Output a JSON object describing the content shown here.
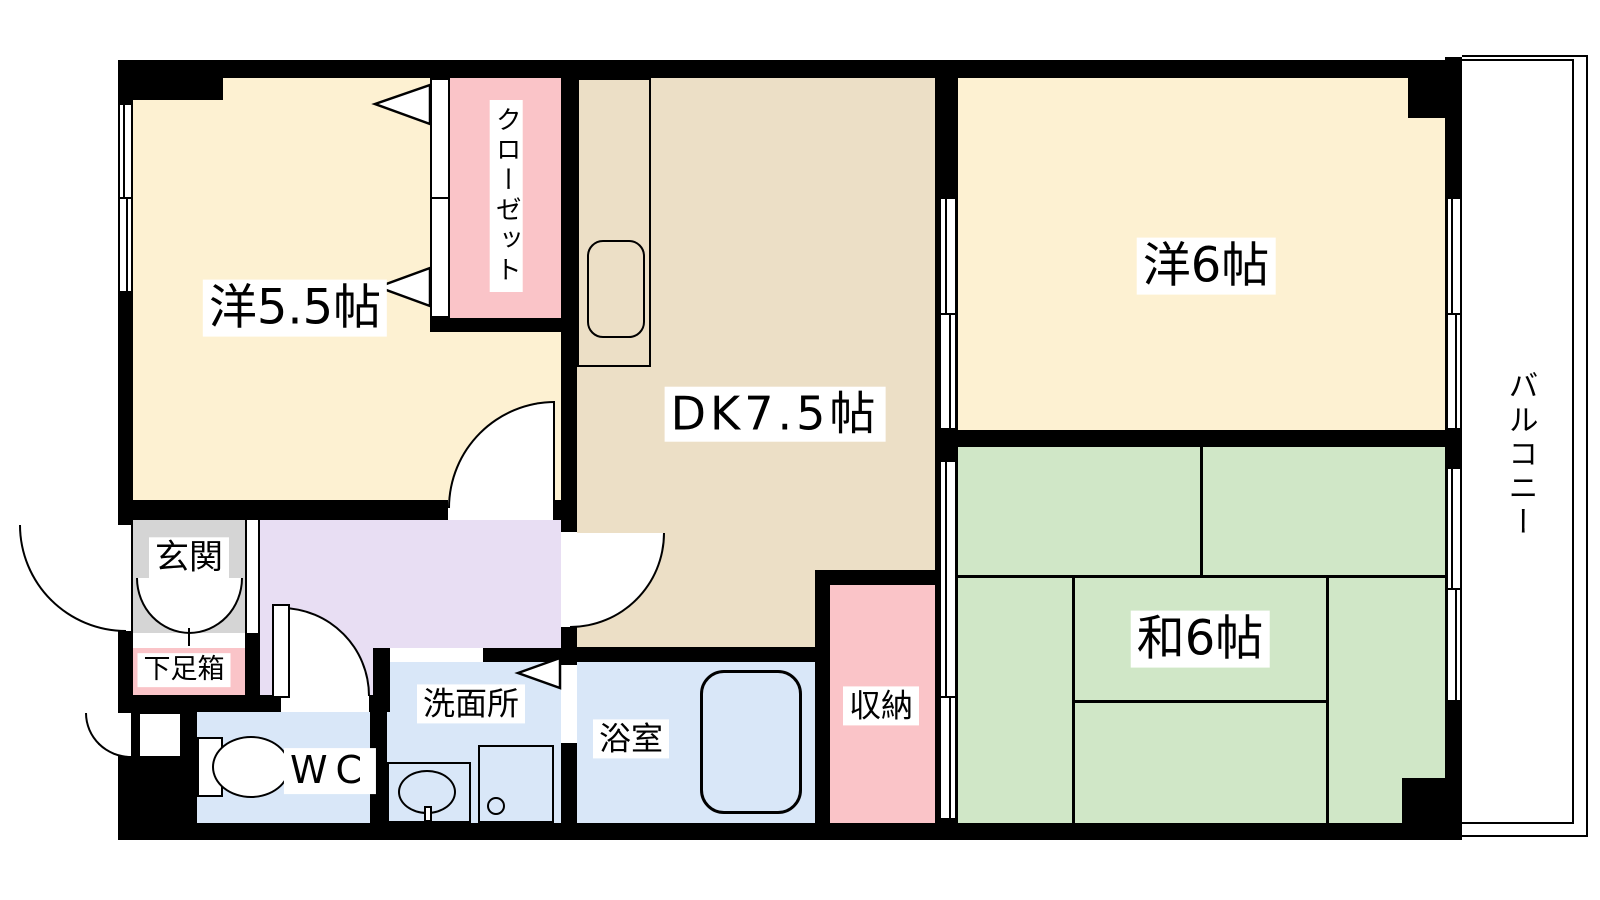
{
  "palette": {
    "western_room": "#fdf1d2",
    "dk": "#ecdfc6",
    "tatami": "#d0e7c7",
    "closet_pink": "#fac4c8",
    "entrance_gray": "#d5d5d5",
    "hall_purple": "#e8def3",
    "wet_blue": "#d9e7f8",
    "wall": "#000000",
    "balcony_bg": "#ffffff"
  },
  "rooms": {
    "west_room_55": {
      "label": "洋5.5帖"
    },
    "closet": {
      "label": "クローゼット"
    },
    "dining_kitchen": {
      "label": "DK7.5帖"
    },
    "west_room_6": {
      "label": "洋6帖"
    },
    "balcony": {
      "label": "バルコニー"
    },
    "japanese_room_6": {
      "label": "和6帖"
    },
    "storage": {
      "label": "収納"
    },
    "entrance": {
      "label": "玄関"
    },
    "shoe_cabinet": {
      "label": "下足箱"
    },
    "toilet": {
      "label": "WC"
    },
    "washroom": {
      "label": "洗面所"
    },
    "bathroom": {
      "label": "浴室"
    }
  }
}
